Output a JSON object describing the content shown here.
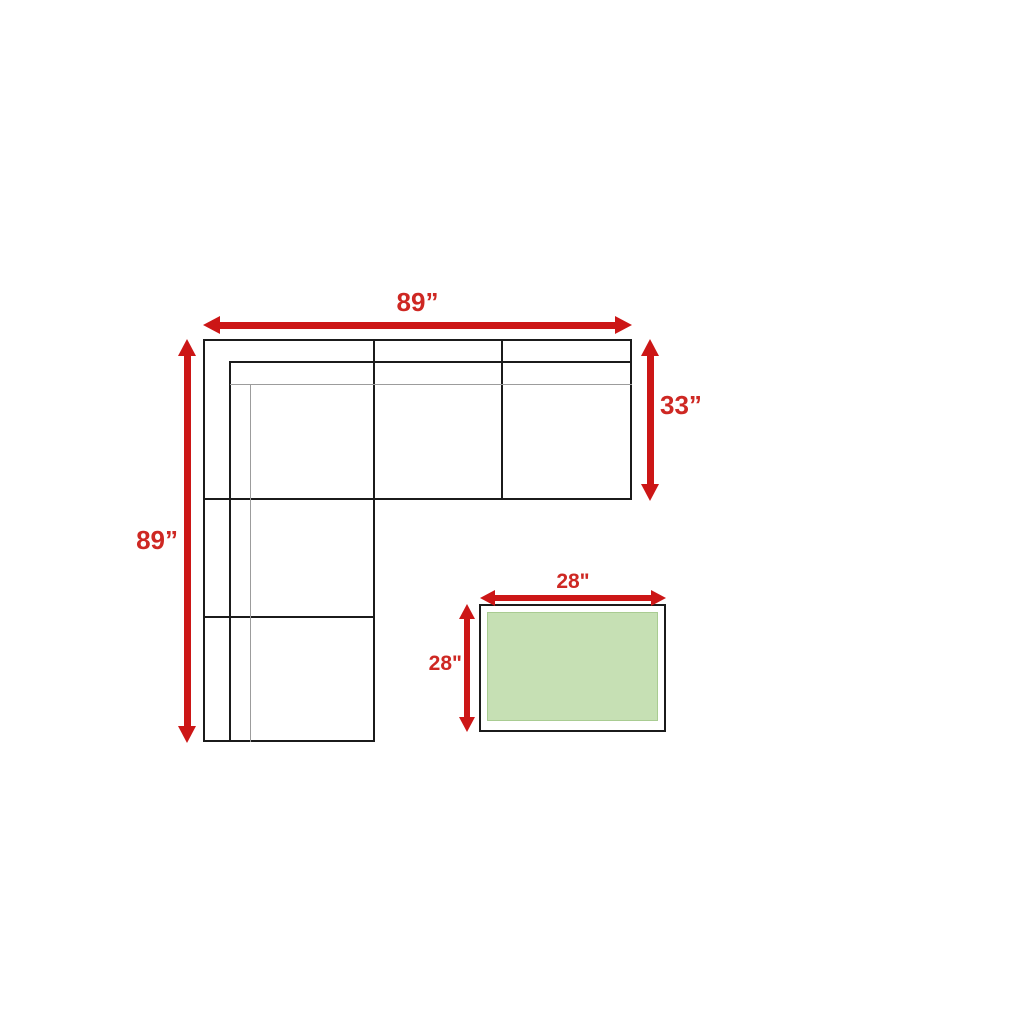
{
  "colors": {
    "arrow-red": "#cc1616",
    "label-red": "#ce2823",
    "line-black": "#1b1b1b",
    "line-gray": "#9c9c9c",
    "table-green": "#c6e0b4",
    "table-green-border": "#a9cc92",
    "background": "#ffffff"
  },
  "sofa": {
    "width_label": "89”",
    "left_length_label": "89”",
    "right_depth_label": "33”"
  },
  "table": {
    "width_label": "28\"",
    "depth_label": "28\""
  }
}
